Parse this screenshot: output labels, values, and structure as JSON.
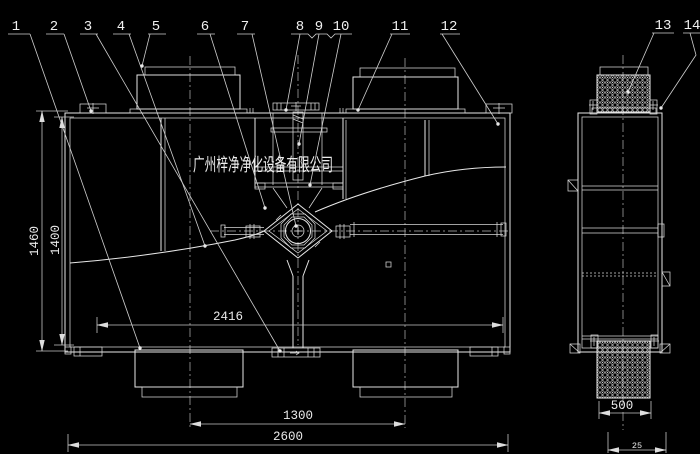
{
  "watermark": "广州梓净净化设备有限公司",
  "labels": {
    "l1": "1",
    "l2": "2",
    "l3": "3",
    "l4": "4",
    "l5": "5",
    "l6": "6",
    "l7": "7",
    "l8": "8",
    "l9": "9",
    "l10": "10",
    "l11": "11",
    "l12": "12",
    "l13": "13",
    "l14": "14"
  },
  "dims": {
    "height_outer": "1460",
    "height_inner": "1400",
    "width_inner": "2416",
    "port_spacing": "1300",
    "width_overall": "2600",
    "side_width": "500",
    "side_bottom": "25"
  },
  "colors": {
    "background": "#000000",
    "line": "#e8e8e8",
    "dim_line": "#c6c6c6",
    "text": "#f0f0f0"
  }
}
